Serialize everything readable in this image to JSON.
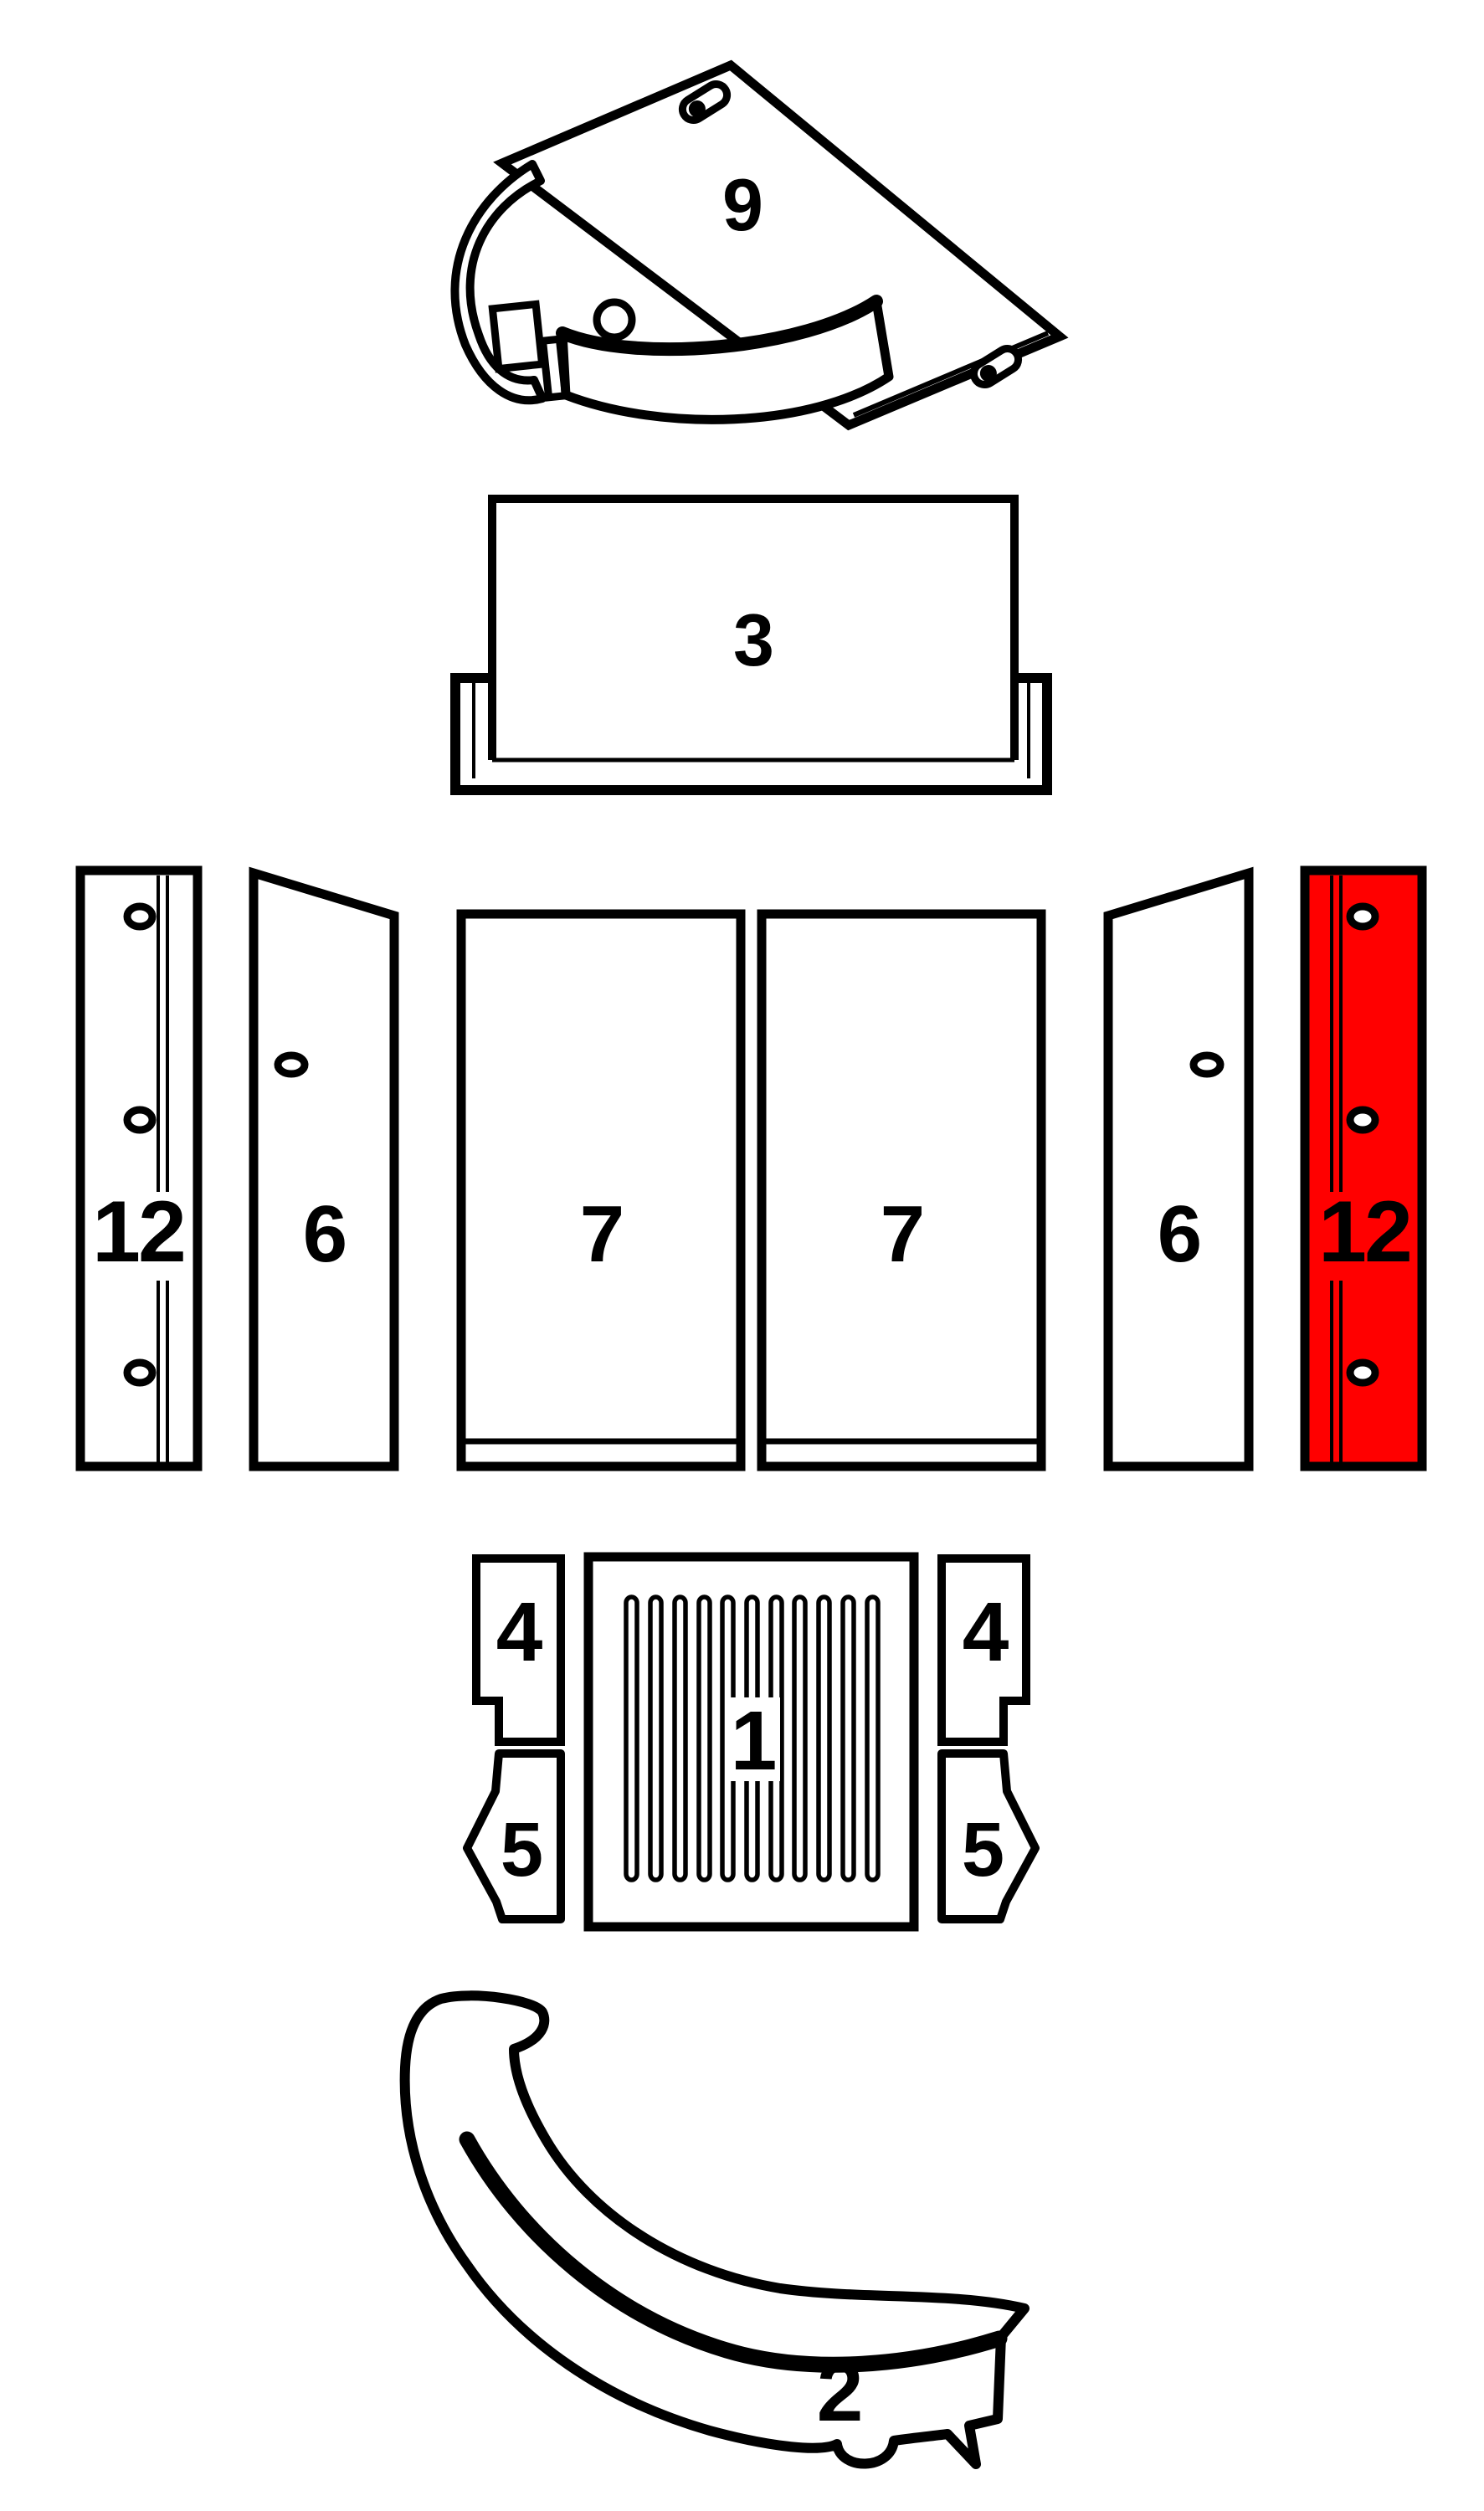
{
  "colors": {
    "line": "#000000",
    "background": "#ffffff",
    "highlight": "#ff0000"
  },
  "parts": [
    {
      "name": "baffle-plate-top",
      "label": "9",
      "highlighted": false
    },
    {
      "name": "back-liner-upper",
      "label": "3",
      "highlighted": false
    },
    {
      "name": "side-strip-outer-left",
      "label": "12",
      "highlighted": false
    },
    {
      "name": "side-panel-left",
      "label": "6",
      "highlighted": false
    },
    {
      "name": "back-panel-left",
      "label": "7",
      "highlighted": false
    },
    {
      "name": "back-panel-right",
      "label": "7",
      "highlighted": false
    },
    {
      "name": "side-panel-right",
      "label": "6",
      "highlighted": false
    },
    {
      "name": "side-strip-outer-right",
      "label": "12",
      "highlighted": true
    },
    {
      "name": "front-block-left",
      "label": "4",
      "highlighted": false
    },
    {
      "name": "grate",
      "label": "1",
      "highlighted": false
    },
    {
      "name": "front-block-right",
      "label": "4",
      "highlighted": false
    },
    {
      "name": "corner-block-left",
      "label": "5",
      "highlighted": false
    },
    {
      "name": "corner-block-right",
      "label": "5",
      "highlighted": false
    },
    {
      "name": "front-arch-bumper",
      "label": "2",
      "highlighted": false
    }
  ]
}
